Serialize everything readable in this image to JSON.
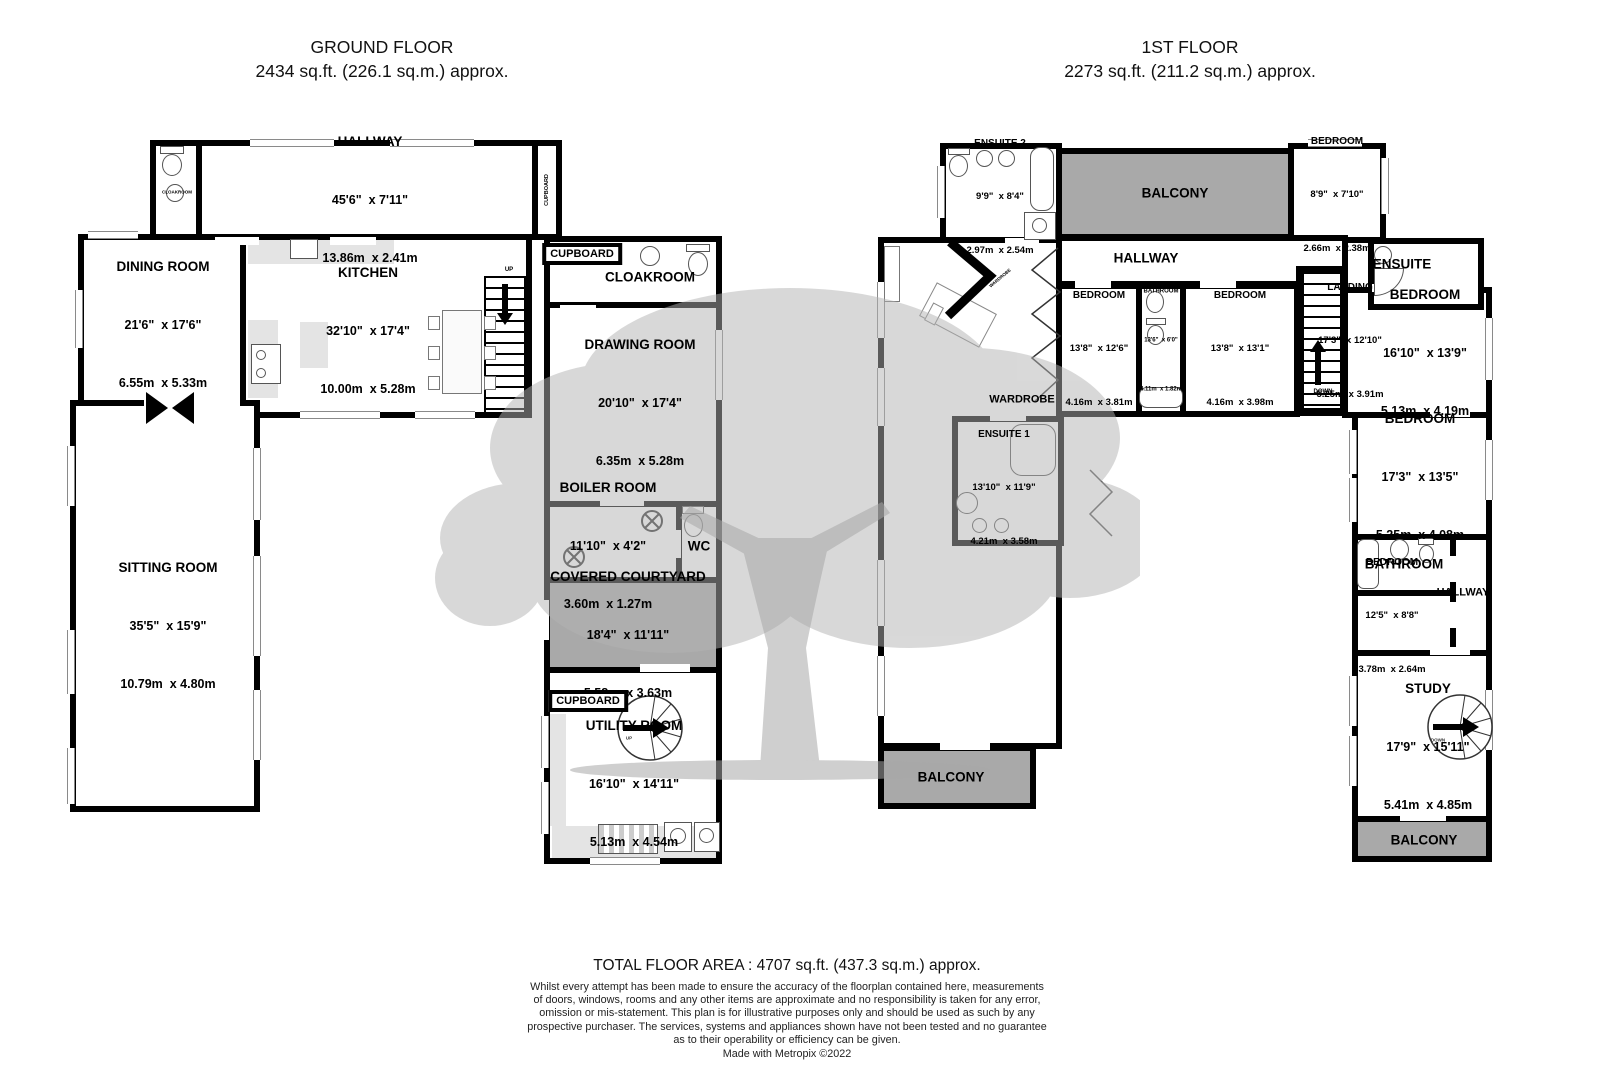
{
  "headers": {
    "ground_title": "GROUND FLOOR",
    "ground_area": "2434 sq.ft. (226.1 sq.m.) approx.",
    "first_title": "1ST FLOOR",
    "first_area": "2273 sq.ft. (211.2 sq.m.) approx."
  },
  "ground": {
    "hallway": {
      "name": "HALLWAY",
      "ft": "45'6\"  x 7'11\"",
      "m": "13.86m  x 2.41m"
    },
    "dining": {
      "name": "DINING ROOM",
      "ft": "21'6\"  x 17'6\"",
      "m": "6.55m  x 5.33m"
    },
    "kitchen": {
      "name": "KITCHEN",
      "ft": "32'10\"  x 17'4\"",
      "m": "10.00m  x 5.28m"
    },
    "cloakroom": {
      "name": "CLOAKROOM"
    },
    "cloakroom_small": {
      "name": "CLOAKROOM"
    },
    "cupboard_hall": {
      "name": "CUPBOARD"
    },
    "cupboard_top": {
      "name": "CUPBOARD"
    },
    "cupboard_bottom": {
      "name": "CUPBOARD"
    },
    "drawing": {
      "name": "DRAWING ROOM",
      "ft": "20'10\"  x 17'4\"",
      "m": "6.35m  x 5.28m"
    },
    "sitting": {
      "name": "SITTING ROOM",
      "ft": "35'5\"  x 15'9\"",
      "m": "10.79m  x 4.80m"
    },
    "boiler": {
      "name": "BOILER ROOM",
      "ft": "11'10\"  x 4'2\"",
      "m": "3.60m  x 1.27m"
    },
    "wc": {
      "name": "WC"
    },
    "courtyard": {
      "name": "COVERED COURTYARD",
      "ft": "18'4\"  x 11'11\"",
      "m": "5.58m  x 3.63m"
    },
    "utility": {
      "name": "UTILITY ROOM",
      "ft": "16'10\"  x 14'11\"",
      "m": "5.13m  x 4.54m"
    }
  },
  "first": {
    "ensuite2": {
      "name": "ENSUITE 2",
      "ft": "9'9\"  x 8'4\"",
      "m": "2.97m  x 2.54m"
    },
    "balcony_top": {
      "name": "BALCONY"
    },
    "bedroom_small": {
      "name": "BEDROOM",
      "ft": "8'9\"  x 7'10\"",
      "m": "2.66m  x 2.38m"
    },
    "hallway": {
      "name": "HALLWAY"
    },
    "ensuite": {
      "name": "ENSUITE"
    },
    "bedroom1": {
      "name": "BEDROOM",
      "ft": "13'8\"  x 12'6\"",
      "m": "4.16m  x 3.81m"
    },
    "bathroom_mid": {
      "name": "BATHROOM",
      "ft": "13'6\"  x 6'0\"",
      "m": "4.11m  x 1.82m"
    },
    "bedroom2": {
      "name": "BEDROOM",
      "ft": "13'8\"  x 13'1\"",
      "m": "4.16m  x 3.98m"
    },
    "landing": {
      "name": "LANDING",
      "ft": "17'3\"  x 12'10\"",
      "m": "5.25m  x 3.91m"
    },
    "bedroom3": {
      "name": "BEDROOM",
      "ft": "16'10\"  x 13'9\"",
      "m": "5.13m  x 4.19m"
    },
    "wardrobe": {
      "name": "WARDROBE"
    },
    "wardrobe_small": {
      "name": "WARDROBE"
    },
    "ensuite1": {
      "name": "ENSUITE 1",
      "ft": "13'10\"  x 11'9\"",
      "m": "4.21m  x 3.58m"
    },
    "bedroom4": {
      "name": "BEDROOM",
      "ft": "17'3\"  x 13'5\"",
      "m": "5.25m  x 4.08m"
    },
    "bathroom2": {
      "name": "BATHROOM"
    },
    "hallway2": {
      "name": "HALLWAY"
    },
    "bedroom5": {
      "name": "BEDROOM",
      "ft": "12'5\"  x 8'8\"",
      "m": "3.78m  x 2.64m"
    },
    "study": {
      "name": "STUDY",
      "ft": "17'9\"  x 15'11\"",
      "m": "5.41m  x 4.85m"
    },
    "balcony_left": {
      "name": "BALCONY"
    },
    "balcony_right": {
      "name": "BALCONY"
    }
  },
  "misc": {
    "up": "UP",
    "down": "DOWN"
  },
  "footer": {
    "total": "TOTAL FLOOR AREA : 4707 sq.ft. (437.3 sq.m.) approx.",
    "disclaimer1": "Whilst every attempt has been made to ensure the accuracy of the floorplan contained here, measurements",
    "disclaimer2": "of doors, windows, rooms and any other items are approximate and no responsibility is taken for any error,",
    "disclaimer3": "omission or mis-statement. This plan is for illustrative purposes only and should be used as such by any",
    "disclaimer4": "prospective purchaser. The services, systems and appliances shown have not been tested and no guarantee",
    "disclaimer5": "as to their operability or efficiency can be given.",
    "credit": "Made with Metropix ©2022"
  },
  "colors": {
    "wall": "#000000",
    "balcony_fill": "#a9a9a9",
    "tree": "#b5b5b5"
  }
}
